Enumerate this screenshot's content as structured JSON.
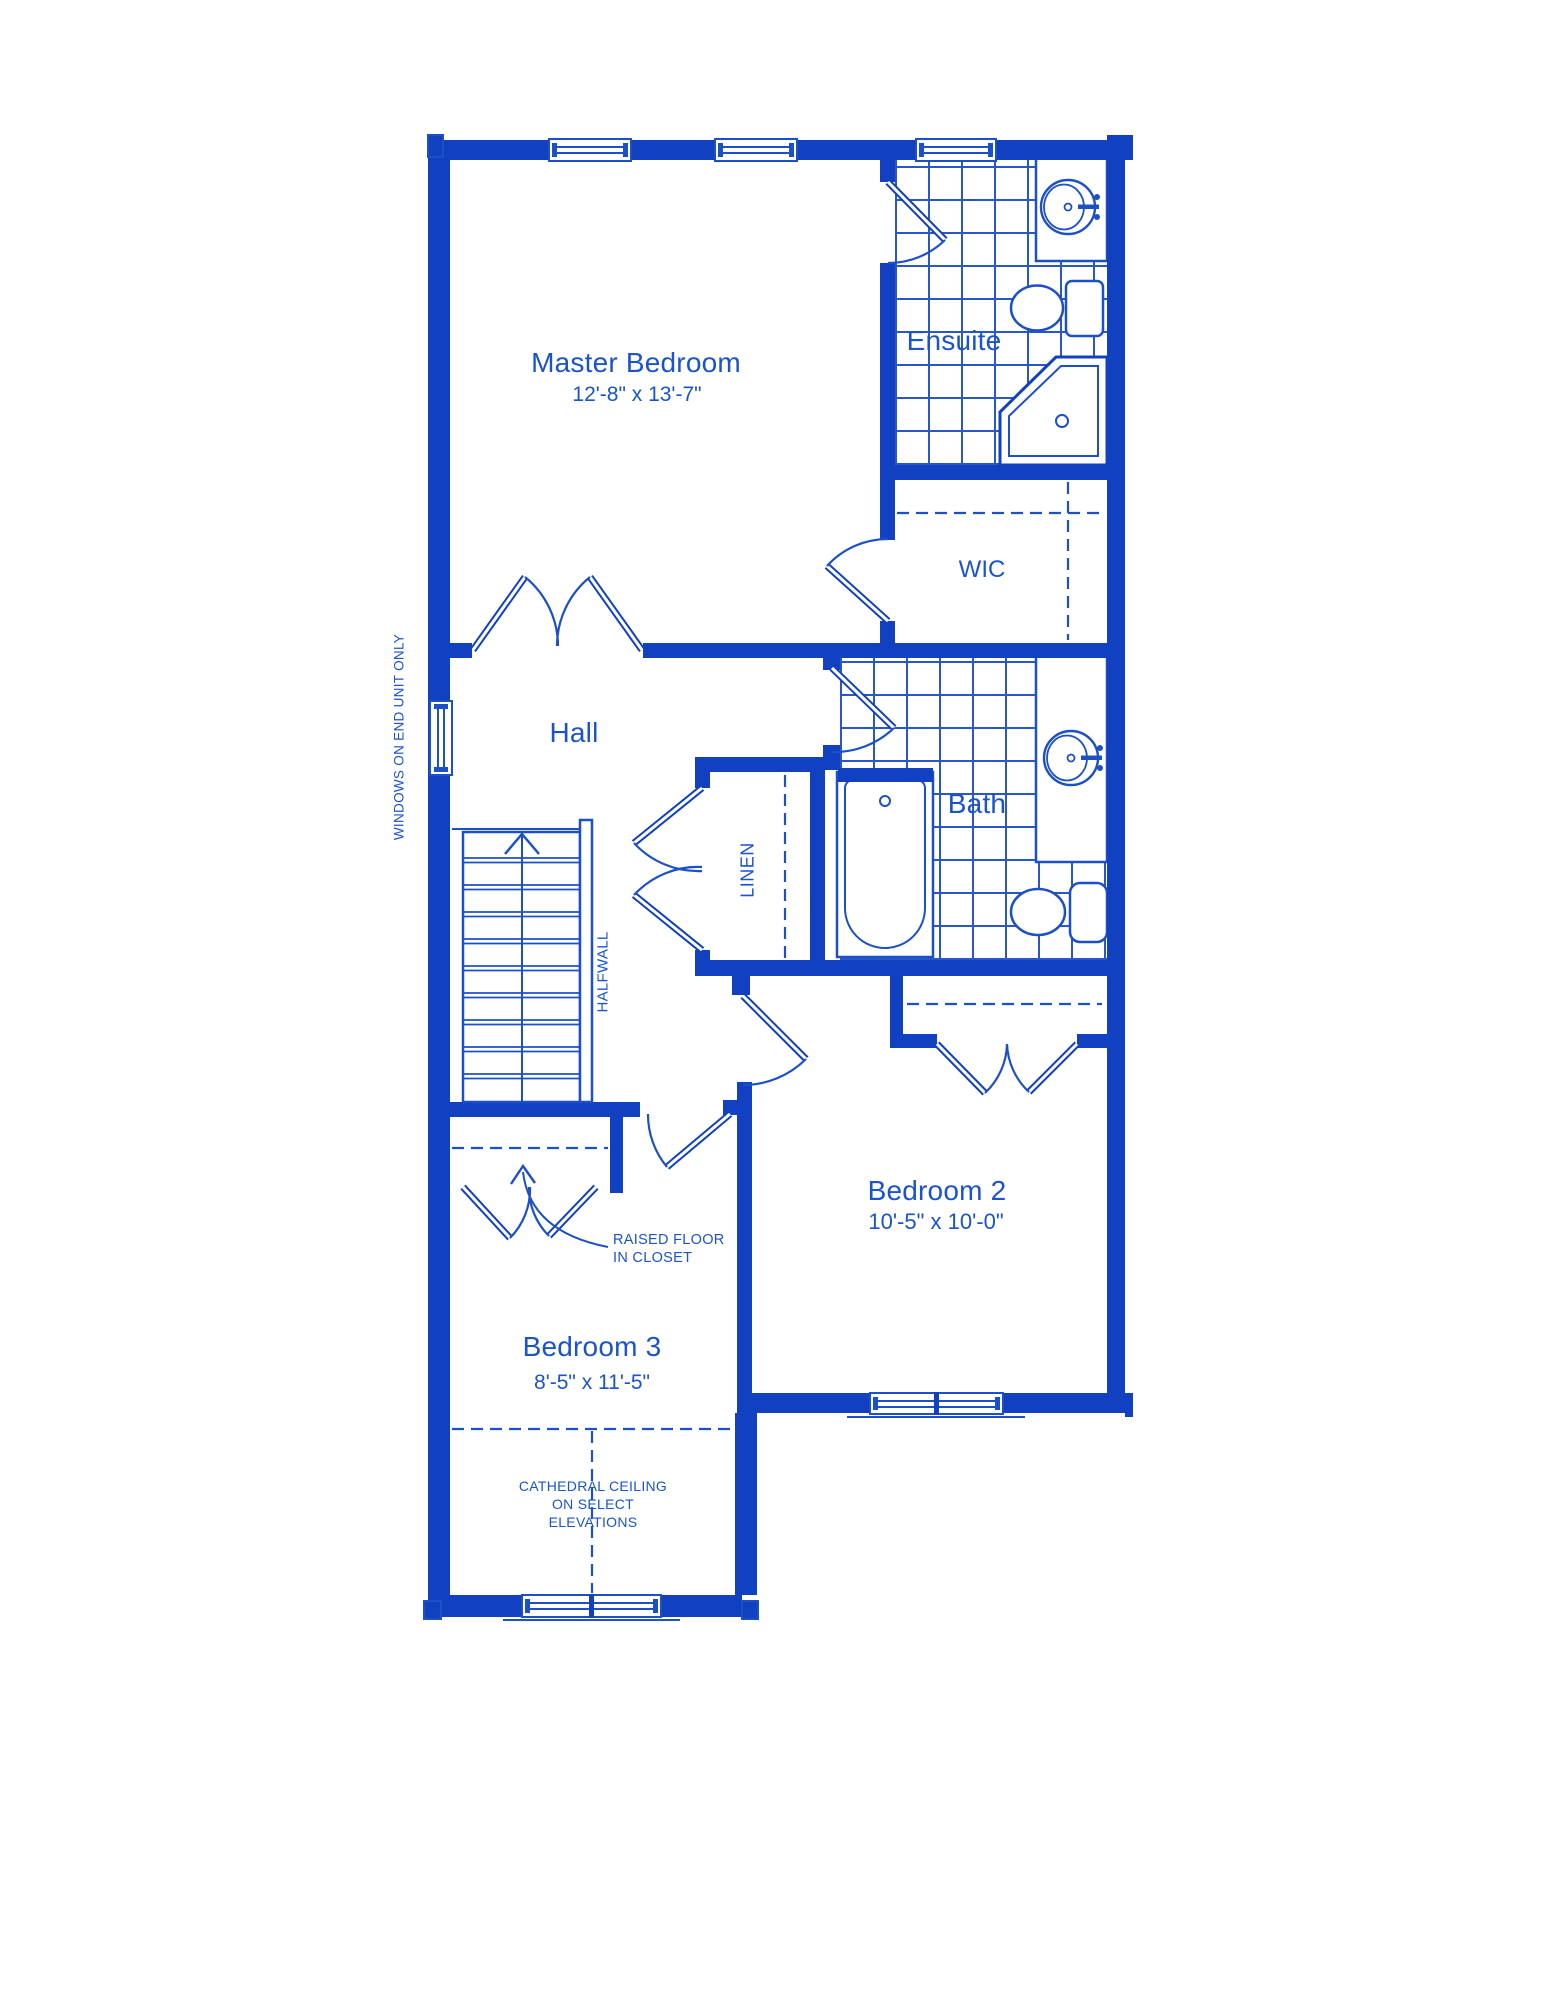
{
  "title": "Second floor plan",
  "colors": {
    "wall_blue": "#1141c1",
    "line_blue": "#1c50c8",
    "text_blue": "#1a53cd",
    "background": "#ffffff"
  },
  "rooms": {
    "master_bedroom": {
      "label": "Master Bedroom",
      "dimensions": "12'-8\" x 13'-7\""
    },
    "ensuite": {
      "label": "Ensuite"
    },
    "wic": {
      "label": "WIC"
    },
    "hall": {
      "label": "Hall"
    },
    "bath": {
      "label": "Bath"
    },
    "linen": {
      "label": "LINEN"
    },
    "bedroom_2": {
      "label": "Bedroom 2",
      "dimensions": "10'-5\" x 10'-0\""
    },
    "bedroom_3": {
      "label": "Bedroom 3",
      "dimensions": "8'-5\" x 11'-5\""
    }
  },
  "annotations": {
    "windows_note": "WINDOWS ON END UNIT ONLY",
    "halfwall": "HALFWALL",
    "raised_floor_line1": "RAISED FLOOR",
    "raised_floor_line2": "IN CLOSET",
    "cathedral_line1": "CATHEDRAL CEILING",
    "cathedral_line2": "ON SELECT",
    "cathedral_line3": "ELEVATIONS"
  }
}
